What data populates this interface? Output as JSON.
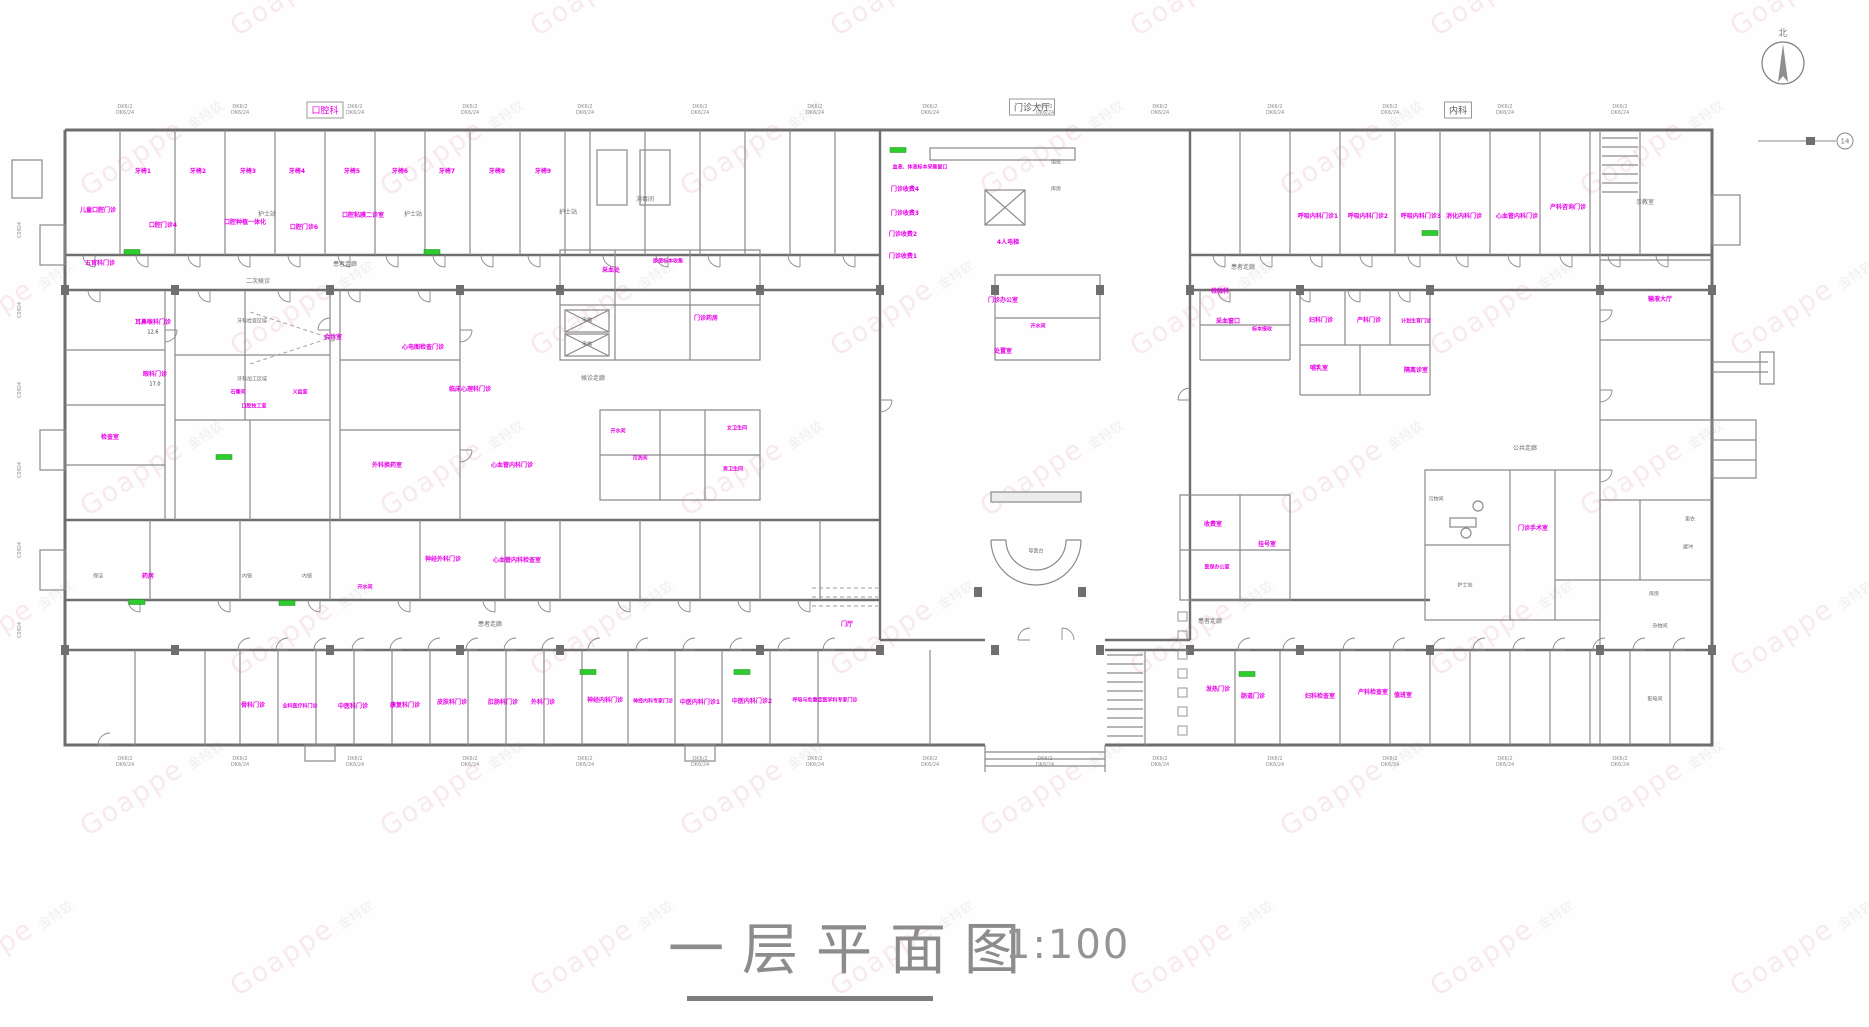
{
  "watermark": {
    "brand": "Goappe",
    "cn": "金特软"
  },
  "title": {
    "text": "一层平面图",
    "scale": "1:100"
  },
  "compass": {
    "north_label": "北"
  },
  "grid_marker": "14",
  "section_labels": [
    {
      "text": "口腔科",
      "x": 325,
      "y": 110,
      "c": "m"
    },
    {
      "text": "门诊大厅",
      "x": 1032,
      "y": 107,
      "c": "k"
    },
    {
      "text": "内科",
      "x": 1458,
      "y": 110,
      "c": "k"
    }
  ],
  "dims": {
    "line1": "DK6/2",
    "line2": "DK6/24",
    "top_xs": [
      125,
      240,
      355,
      470,
      585,
      700,
      815,
      930,
      1045,
      1160,
      1275,
      1390,
      1505,
      1620
    ],
    "bottom_xs": [
      125,
      240,
      355,
      470,
      585,
      700,
      815,
      930,
      1045,
      1160,
      1275,
      1390,
      1505,
      1620
    ],
    "left_ys": [
      230,
      310,
      390,
      470,
      550,
      630
    ],
    "left_text": "C0924"
  },
  "rooms": [
    [
      143,
      172,
      "牙椅1",
      "m"
    ],
    [
      198,
      172,
      "牙椅2",
      "m"
    ],
    [
      248,
      172,
      "牙椅3",
      "m"
    ],
    [
      297,
      172,
      "牙椅4",
      "m"
    ],
    [
      352,
      172,
      "牙椅5",
      "m"
    ],
    [
      400,
      172,
      "牙椅6",
      "m"
    ],
    [
      447,
      172,
      "牙椅7",
      "m"
    ],
    [
      497,
      172,
      "牙椅8",
      "m"
    ],
    [
      543,
      172,
      "牙椅9",
      "m"
    ],
    [
      98,
      211,
      "儿童口腔门诊",
      "m"
    ],
    [
      163,
      226,
      "口腔门诊4",
      "m"
    ],
    [
      245,
      223,
      "口腔种植一体化",
      "m"
    ],
    [
      304,
      228,
      "口腔门诊6",
      "m"
    ],
    [
      363,
      216,
      "口腔粘膜二诊室",
      "m"
    ],
    [
      267,
      215,
      "护士站",
      "g"
    ],
    [
      413,
      215,
      "护士站",
      "g"
    ],
    [
      568,
      213,
      "护士站",
      "g"
    ],
    [
      645,
      200,
      "消毒间",
      "g"
    ],
    [
      258,
      282,
      "二次候诊",
      "g"
    ],
    [
      345,
      265,
      "患者走廊",
      "g"
    ],
    [
      1243,
      268,
      "患者走廊",
      "g"
    ],
    [
      920,
      168,
      "血液、体液标本采集窗口",
      "m",
      5
    ],
    [
      905,
      190,
      "门诊收费4",
      "m"
    ],
    [
      905,
      214,
      "门诊收费3",
      "m"
    ],
    [
      903,
      235,
      "门诊收费2",
      "m"
    ],
    [
      903,
      257,
      "门诊收费1",
      "m"
    ],
    [
      1008,
      243,
      "4人电梯",
      "m"
    ],
    [
      1056,
      163,
      "值班",
      "g",
      5
    ],
    [
      1056,
      190,
      "库房",
      "g",
      5
    ],
    [
      1036,
      552,
      "导医台",
      "g",
      5
    ],
    [
      847,
      625,
      "门厅",
      "m"
    ],
    [
      1318,
      217,
      "呼吸内科门诊1",
      "m"
    ],
    [
      1368,
      217,
      "呼吸内科门诊2",
      "m"
    ],
    [
      1421,
      217,
      "呼吸内科门诊3",
      "m"
    ],
    [
      1464,
      217,
      "消化内科门诊",
      "m"
    ],
    [
      1517,
      217,
      "心血管内科门诊",
      "m"
    ],
    [
      1568,
      208,
      "产科咨询门诊",
      "m"
    ],
    [
      1645,
      203,
      "示教室",
      "g"
    ],
    [
      153,
      323,
      "耳鼻喉科门诊",
      "m"
    ],
    [
      153,
      333,
      "12.6",
      "k",
      5
    ],
    [
      155,
      375,
      "眼科门诊",
      "m"
    ],
    [
      155,
      385,
      "17.0",
      "k",
      5
    ],
    [
      100,
      264,
      "五官科门诊",
      "m"
    ],
    [
      110,
      438,
      "检查室",
      "m"
    ],
    [
      252,
      322,
      "牙科检查区域",
      "g",
      5
    ],
    [
      252,
      380,
      "牙科加工区域",
      "g",
      5
    ],
    [
      333,
      338,
      "会诊室",
      "m"
    ],
    [
      238,
      393,
      "石膏间",
      "m",
      5
    ],
    [
      254,
      407,
      "口腔技工室",
      "m",
      5
    ],
    [
      300,
      393,
      "义齿室",
      "m",
      5
    ],
    [
      423,
      348,
      "心电图检查门诊",
      "m"
    ],
    [
      470,
      390,
      "临床心理科门诊",
      "m"
    ],
    [
      611,
      271,
      "采血处",
      "m"
    ],
    [
      668,
      262,
      "尿便标本收集",
      "m",
      5
    ],
    [
      706,
      319,
      "门诊药房",
      "m"
    ],
    [
      593,
      379,
      "候诊走廊",
      "g"
    ],
    [
      587,
      321,
      "电梯",
      "g",
      5
    ],
    [
      587,
      345,
      "电梯",
      "g",
      5
    ],
    [
      618,
      432,
      "开水间",
      "m",
      5
    ],
    [
      640,
      459,
      "污洗间",
      "m",
      5
    ],
    [
      737,
      429,
      "女卫生间",
      "m",
      5
    ],
    [
      733,
      470,
      "男卫生间",
      "m",
      5
    ],
    [
      387,
      466,
      "外科换药室",
      "m"
    ],
    [
      512,
      466,
      "心血管内科门诊",
      "m"
    ],
    [
      443,
      560,
      "神经外科门诊",
      "m"
    ],
    [
      517,
      561,
      "心血管内科检查室",
      "m"
    ],
    [
      98,
      577,
      "保洁",
      "g",
      5
    ],
    [
      148,
      577,
      "药房",
      "m"
    ],
    [
      247,
      577,
      "内镜",
      "g",
      5
    ],
    [
      307,
      577,
      "内镜",
      "g",
      5
    ],
    [
      365,
      588,
      "开水间",
      "m",
      5
    ],
    [
      490,
      625,
      "患者走廊",
      "g"
    ],
    [
      1210,
      622,
      "患者走廊",
      "g"
    ],
    [
      253,
      706,
      "骨科门诊",
      "m"
    ],
    [
      300,
      707,
      "全科医疗科门诊",
      "m",
      5
    ],
    [
      353,
      707,
      "中医科门诊",
      "m"
    ],
    [
      405,
      706,
      "康复科门诊",
      "m"
    ],
    [
      452,
      703,
      "皮肤科门诊",
      "m"
    ],
    [
      503,
      703,
      "肛肠科门诊",
      "m"
    ],
    [
      543,
      703,
      "外科门诊",
      "m"
    ],
    [
      605,
      701,
      "神经内科门诊",
      "m"
    ],
    [
      653,
      702,
      "神经内科专家门诊",
      "m",
      5
    ],
    [
      700,
      703,
      "中医内科门诊1",
      "m"
    ],
    [
      752,
      702,
      "中医内科门诊2",
      "m"
    ],
    [
      825,
      701,
      "呼吸与危重症医学科专家门诊",
      "m",
      5
    ],
    [
      1003,
      301,
      "门诊办公室",
      "m"
    ],
    [
      1038,
      327,
      "开水间",
      "m",
      5
    ],
    [
      1003,
      352,
      "处置室",
      "m"
    ],
    [
      1220,
      292,
      "检验科",
      "m"
    ],
    [
      1228,
      322,
      "采血窗口",
      "m"
    ],
    [
      1262,
      330,
      "标本接收",
      "m",
      5
    ],
    [
      1321,
      321,
      "妇科门诊",
      "m"
    ],
    [
      1369,
      321,
      "产科门诊",
      "m"
    ],
    [
      1416,
      322,
      "计划生育门诊",
      "m",
      5
    ],
    [
      1319,
      369,
      "哺乳室",
      "m"
    ],
    [
      1416,
      371,
      "隔离诊室",
      "m"
    ],
    [
      1213,
      525,
      "收费室",
      "m"
    ],
    [
      1267,
      545,
      "挂号室",
      "m"
    ],
    [
      1217,
      568,
      "医保办公室",
      "m",
      5
    ],
    [
      1533,
      529,
      "门诊手术室",
      "m"
    ],
    [
      1525,
      449,
      "公共走廊",
      "g"
    ],
    [
      1465,
      586,
      "护士站",
      "g",
      5
    ],
    [
      1436,
      500,
      "污物间",
      "g",
      5
    ],
    [
      1690,
      520,
      "更衣",
      "g",
      5
    ],
    [
      1688,
      548,
      "缓冲",
      "g",
      5
    ],
    [
      1218,
      690,
      "发热门诊",
      "m"
    ],
    [
      1253,
      697,
      "肠道门诊",
      "m"
    ],
    [
      1320,
      697,
      "妇科检查室",
      "m"
    ],
    [
      1373,
      693,
      "产科检查室",
      "m"
    ],
    [
      1403,
      696,
      "值班室",
      "m"
    ],
    [
      1654,
      595,
      "库房",
      "g",
      5
    ],
    [
      1660,
      627,
      "杂物间",
      "g",
      5
    ],
    [
      1655,
      700,
      "配电间",
      "g",
      5
    ],
    [
      1660,
      300,
      "输液大厅",
      "m"
    ]
  ]
}
